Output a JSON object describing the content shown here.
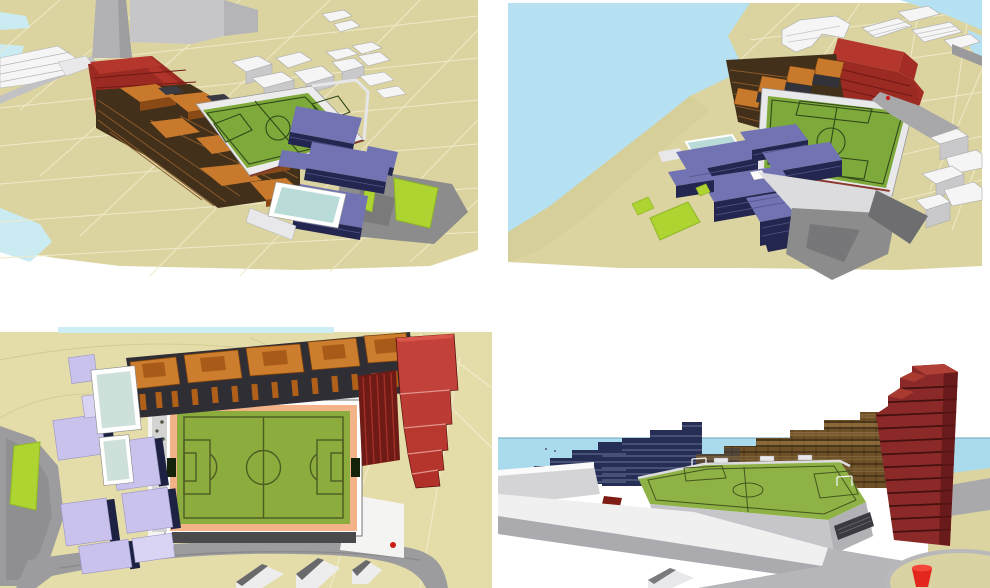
{
  "figure": {
    "type": "architectural-massing-montage",
    "panel_count": 4,
    "panels": [
      {
        "id": "top-left",
        "view": "aerial-perspective-from-west",
        "features": [
          "football-pitch",
          "red-stepped-block",
          "orange-terrace-housing",
          "purple-office-blocks",
          "swimming-pool",
          "grey-context-buildings",
          "waterfront",
          "sand-terrain-grid"
        ]
      },
      {
        "id": "top-right",
        "view": "aerial-perspective-from-north-over-water",
        "features": [
          "sea",
          "football-pitch",
          "red-stepped-block",
          "orange-terrace-housing",
          "purple-office-blocks",
          "swimming-pool",
          "white-context-buildings",
          "lawns",
          "rock-plaza"
        ]
      },
      {
        "id": "bottom-left",
        "view": "top-down-site-plan",
        "features": [
          "football-pitch-with-running-track-apron",
          "orange-housing-row",
          "red-stepped-terraces",
          "lavender-residential-blocks",
          "glass-courts",
          "access-roads",
          "lawn"
        ]
      },
      {
        "id": "bottom-right",
        "view": "eye-level-perspective-from-plaza",
        "features": [
          "sea-horizon",
          "navy-stepped-blocks",
          "elevated-football-pitch",
          "bronze-glass-terraces",
          "dark-red-tower",
          "white-ramps",
          "sand-roundabout",
          "red-cone"
        ]
      }
    ]
  },
  "colors": {
    "sand": "#dbd4a0",
    "sand_light": "#e5dda9",
    "sand_circle": "#d9d2a2",
    "grid": "#f0e9c9",
    "water_tl": "#c9ebf1",
    "water_tr": "#b5e1f2",
    "water_bl": "#cdeef6",
    "sea_br": "#a9dbec",
    "horizon": "#84b4c9",
    "grass": "#7ea93b",
    "grass_plan": "#8cad3d",
    "grass_br": "#8eb246",
    "pitch_line": "#31491a",
    "pitch_line_plan": "#4c5c22",
    "lawn": "#aed432",
    "red_top": "#b5362c",
    "red_front": "#9a2a22",
    "red_dark": "#6f1913",
    "red_plan": "#c2413a",
    "tower": "#8b2828",
    "tower_line": "#42110e",
    "orange": "#c8792c",
    "orange_dark": "#8a4a16",
    "orange_plan": "#cd7d2e",
    "terrace_dark": "#42301a",
    "slat": "#8a5a2c",
    "purple_roof": "#7173b3",
    "purple_side": "#23264e",
    "purple_band": "#53568a",
    "lavender": "#c8c2ec",
    "lavender_dark": "#1e2242",
    "glass": "#cde0da",
    "pool": "#b9dcd8",
    "navy": "#272e55",
    "navy_band": "#6b7296",
    "bronze": "#6f5128",
    "bronze_light": "#a3824c",
    "bronze_line": "#2c1e10",
    "white_top": "#f5f5f5",
    "white_side": "#c9c9cb",
    "grey_struct": "#c6c6c8",
    "column": "#b2b2b4",
    "plaza": "#8c8c8c",
    "plaza_dark": "#6e6e70",
    "road": "#9c9c9e",
    "platform": "#c6c6ca",
    "platform_side": "#b2b2b6",
    "track": "#f2b388",
    "stand": "#4a4a4c",
    "cone": "#e3271e"
  }
}
